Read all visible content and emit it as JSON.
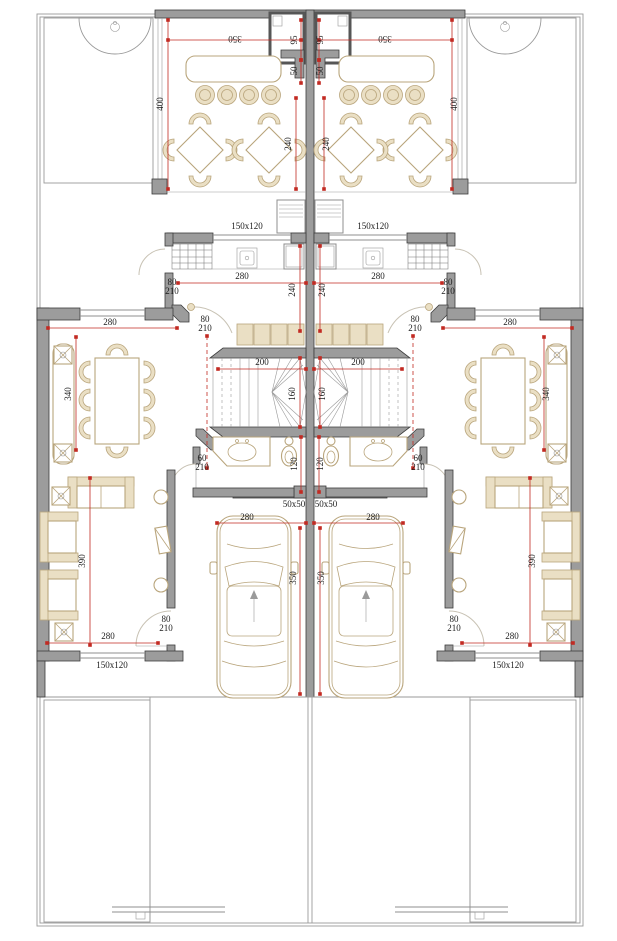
{
  "drawing": {
    "type": "architectural-floor-plan",
    "mirror_axis_x": 310,
    "colors": {
      "wall_fill": "#9c9c9c",
      "wall_stroke": "#3c3c3c",
      "furniture_stroke": "#b9a57c",
      "furniture_fill": "#eadfc4",
      "dimension_red": "#c22a22",
      "label_text": "#1c1c1c",
      "garden_dot": "#b6bdab",
      "line_gray": "#8f8f8f"
    },
    "dimension_labels": [
      {
        "text": "350",
        "x": 235,
        "y": 36,
        "rot": 180,
        "mirror": true
      },
      {
        "text": "95",
        "x": 297,
        "y": 40,
        "rot": -90,
        "mirror": true
      },
      {
        "text": "50",
        "x": 297,
        "y": 71,
        "rot": -90,
        "mirror": true
      },
      {
        "text": "400",
        "x": 163,
        "y": 104,
        "rot": -90,
        "mirror": true
      },
      {
        "text": "240",
        "x": 291,
        "y": 144,
        "rot": -90,
        "mirror": true
      },
      {
        "text": "150x120",
        "x": 247,
        "y": 229,
        "rot": 0,
        "mirror": true
      },
      {
        "text": "280",
        "x": 242,
        "y": 279,
        "rot": 0,
        "mirror": true
      },
      {
        "text": "80",
        "x": 172,
        "y": 285,
        "rot": 0,
        "mirror": true
      },
      {
        "text": "210",
        "x": 172,
        "y": 294,
        "rot": 0,
        "mirror": true
      },
      {
        "text": "240",
        "x": 295,
        "y": 290,
        "rot": -90,
        "mirror": true
      },
      {
        "text": "80",
        "x": 205,
        "y": 322,
        "rot": 0,
        "mirror": true
      },
      {
        "text": "210",
        "x": 205,
        "y": 331,
        "rot": 0,
        "mirror": true
      },
      {
        "text": "280",
        "x": 110,
        "y": 325,
        "rot": 0,
        "mirror": true
      },
      {
        "text": "340",
        "x": 71,
        "y": 394,
        "rot": -90,
        "mirror": true
      },
      {
        "text": "200",
        "x": 262,
        "y": 365,
        "rot": 0,
        "mirror": true
      },
      {
        "text": "160",
        "x": 295,
        "y": 394,
        "rot": -90,
        "mirror": true
      },
      {
        "text": "60",
        "x": 202,
        "y": 461,
        "rot": 0,
        "mirror": true
      },
      {
        "text": "210",
        "x": 202,
        "y": 470,
        "rot": 0,
        "mirror": true
      },
      {
        "text": "120",
        "x": 297,
        "y": 464,
        "rot": -90,
        "mirror": true
      },
      {
        "text": "50x50",
        "x": 294,
        "y": 507,
        "rot": 0,
        "mirror": true
      },
      {
        "text": "280",
        "x": 247,
        "y": 520,
        "rot": 0,
        "mirror": true
      },
      {
        "text": "350",
        "x": 296,
        "y": 578,
        "rot": -90,
        "mirror": true
      },
      {
        "text": "390",
        "x": 85,
        "y": 561,
        "rot": -90,
        "mirror": true
      },
      {
        "text": "280",
        "x": 108,
        "y": 639,
        "rot": 0,
        "mirror": true
      },
      {
        "text": "80",
        "x": 166,
        "y": 622,
        "rot": 0,
        "mirror": true
      },
      {
        "text": "210",
        "x": 166,
        "y": 631,
        "rot": 0,
        "mirror": true
      },
      {
        "text": "150x120",
        "x": 112,
        "y": 668,
        "rot": 0,
        "mirror": true
      }
    ],
    "dimension_lines": [
      {
        "x1": 168,
        "y1": 40,
        "x2": 301,
        "y2": 40,
        "mirror": true
      },
      {
        "x1": 301,
        "y1": 20,
        "x2": 301,
        "y2": 60,
        "mirror": true
      },
      {
        "x1": 301,
        "y1": 60,
        "x2": 301,
        "y2": 83,
        "mirror": true
      },
      {
        "x1": 168,
        "y1": 20,
        "x2": 168,
        "y2": 189,
        "mirror": true
      },
      {
        "x1": 296,
        "y1": 98,
        "x2": 296,
        "y2": 189,
        "mirror": true
      },
      {
        "x1": 178,
        "y1": 283,
        "x2": 306,
        "y2": 283,
        "mirror": true
      },
      {
        "x1": 300,
        "y1": 246,
        "x2": 300,
        "y2": 331,
        "mirror": true
      },
      {
        "x1": 48,
        "y1": 328,
        "x2": 177,
        "y2": 328,
        "mirror": true
      },
      {
        "x1": 76,
        "y1": 337,
        "x2": 76,
        "y2": 450,
        "mirror": true
      },
      {
        "x1": 218,
        "y1": 369,
        "x2": 306,
        "y2": 369,
        "mirror": true
      },
      {
        "x1": 300,
        "y1": 358,
        "x2": 300,
        "y2": 427,
        "mirror": true
      },
      {
        "x1": 301,
        "y1": 437,
        "x2": 301,
        "y2": 492,
        "mirror": true
      },
      {
        "x1": 217,
        "y1": 523,
        "x2": 306,
        "y2": 523,
        "mirror": true
      },
      {
        "x1": 300,
        "y1": 528,
        "x2": 300,
        "y2": 694,
        "mirror": true
      },
      {
        "x1": 90,
        "y1": 478,
        "x2": 90,
        "y2": 645,
        "mirror": true
      },
      {
        "x1": 47,
        "y1": 643,
        "x2": 158,
        "y2": 643,
        "mirror": true
      },
      {
        "x1": 207,
        "y1": 336,
        "x2": 207,
        "y2": 468,
        "dashed": true,
        "mirror": true
      }
    ]
  }
}
